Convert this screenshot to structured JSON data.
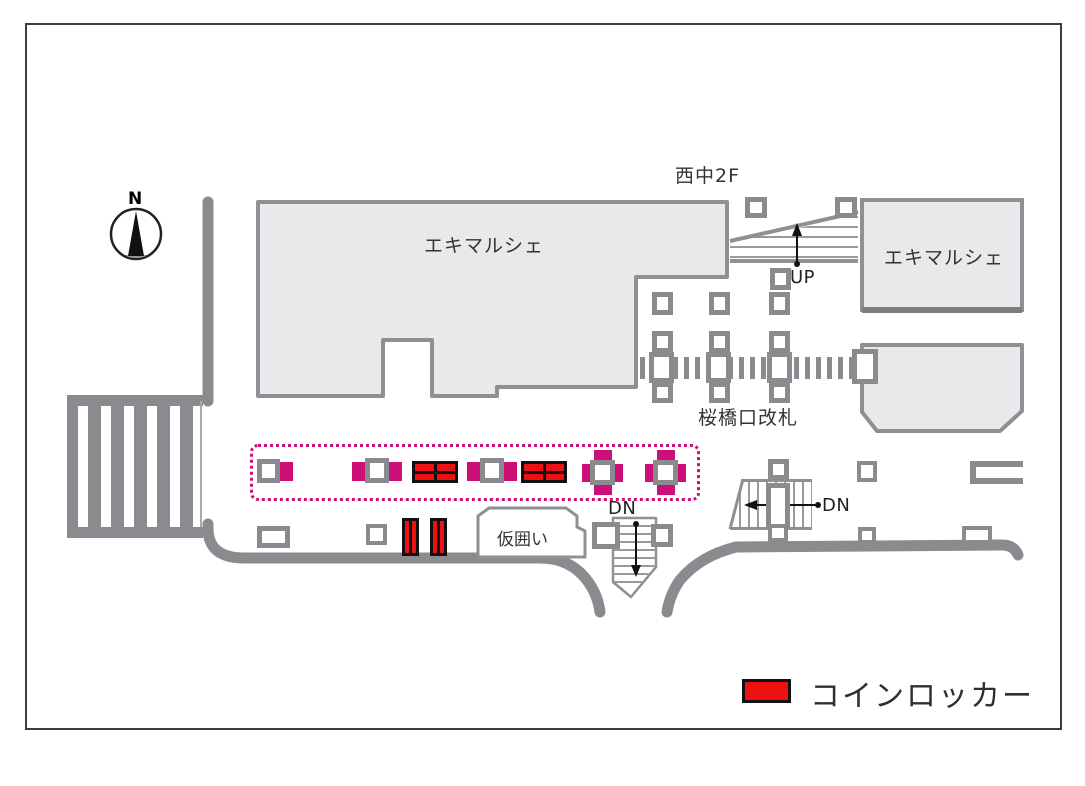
{
  "title": "station-floor-map",
  "compass": {
    "north_label": "N"
  },
  "labels": {
    "nishinaka_2f": "西中2F",
    "ekimarche_left": "エキマルシェ",
    "ekimarche_right": "エキマルシェ",
    "up": "UP",
    "sakurabashi_gate": "桜橋口改札",
    "dn_right": "DN",
    "dn_center": "DN",
    "temporary_enclosure": "仮囲い"
  },
  "legend": {
    "swatch_color": "#ee1111",
    "label": "コインロッカー"
  },
  "colors": {
    "wall_gray": "#8b8b8f",
    "building_fill": "#e9e9eb",
    "locker_zone_magenta": "#cb1179",
    "locker_red": "#ee1111",
    "text": "#333333",
    "frame": "#3c3c40"
  },
  "map": {
    "locker_zone_note": "dotted magenta outline encloses pillar-side lockers",
    "coin_locker_units_horizontal": 2,
    "coin_locker_units_vertical": 2,
    "stairs": [
      "UP",
      "DN",
      "DN"
    ]
  }
}
